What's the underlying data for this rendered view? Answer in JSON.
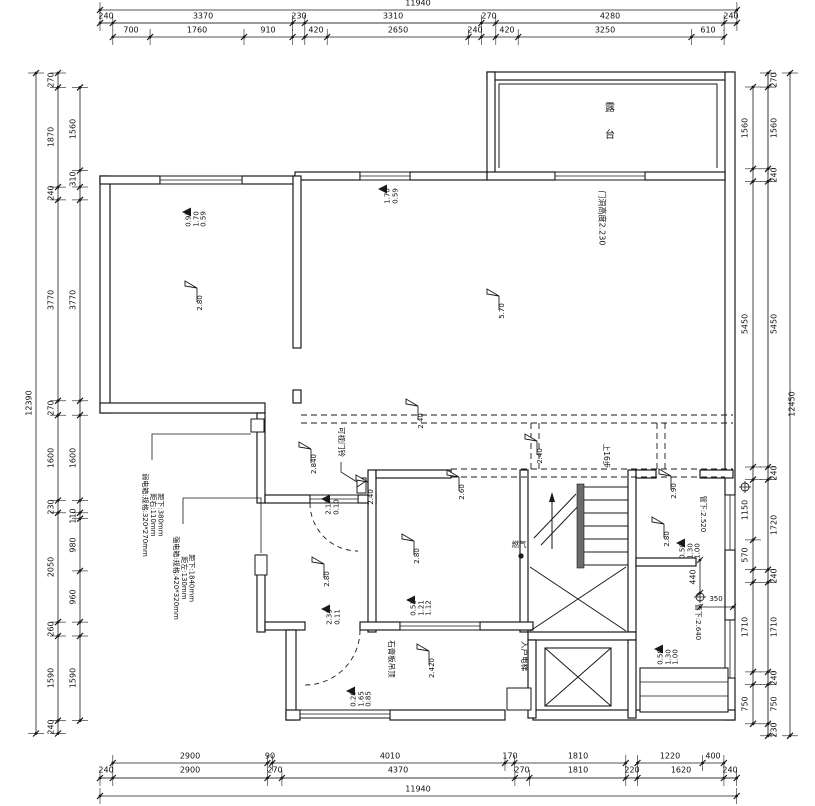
{
  "drawing": {
    "background": "#ffffff",
    "line_color": "#1a1a1a",
    "gray_line": "#9a9a9a",
    "title": "二层平面布置图"
  },
  "dimensions": {
    "top": {
      "total": "11940",
      "row1": [
        "240",
        "3370",
        "230",
        "3310",
        "270",
        "4280",
        "240"
      ],
      "row2": [
        "700",
        "1760",
        "910",
        "420",
        "2650",
        "240",
        "420",
        "3250",
        "610"
      ]
    },
    "bottom": {
      "total": "11940",
      "row1": [
        "2900",
        "90",
        "4010",
        "170",
        "1810",
        "1220",
        "400"
      ],
      "row2": [
        "240",
        "2900",
        "270",
        "4370",
        "270",
        "1810",
        "220",
        "1620",
        "240"
      ]
    },
    "left": {
      "total": "12390",
      "outer": [
        "270",
        "1870",
        "240",
        "3770",
        "270",
        "1600",
        "230",
        "2050",
        "260",
        "1590",
        "240"
      ],
      "inner": [
        "1560",
        "310",
        "3770",
        "1600",
        "110",
        "980",
        "960",
        "1590"
      ]
    },
    "right": {
      "total": "12450",
      "outer": [
        "270",
        "1560",
        "240",
        "5450",
        "240",
        "1720",
        "240",
        "1710",
        "240",
        "750",
        "230"
      ],
      "inner": [
        "1560",
        "5450",
        "1150",
        "570",
        "1710",
        "750"
      ]
    },
    "interior": {
      "w440": "440",
      "w350": "350"
    }
  },
  "rooms": {
    "terrace": "露 台"
  },
  "annotations": {
    "door_height": "门洞高度2.230",
    "doorbell": "可视门铃",
    "stairs_up": "上16步",
    "gas": "燃气",
    "elevator": "入户电梯",
    "ceiling": "石膏板吊顶",
    "pipe_upper": "管下:2.520",
    "pipe_lower": "管下:2.640",
    "weak_box": "弱电箱:规格:320*270mm\n距右:110mm\n距下:380mm",
    "strong_box": "强电箱:规格:420*320mm\n距左:130mm\n距下:1840mm"
  },
  "markers": {
    "heights": [
      "2.80",
      "5.70",
      "2.840",
      "2.40",
      "2.40",
      "2.40",
      "2.60",
      "2.80",
      "2.80",
      "2.90",
      "2.80",
      "2.420"
    ],
    "windows": [
      "0.93\n1.70\n0.59",
      "1.70\n0.59",
      "2.17\n0.10",
      "2.33\n0.11",
      "0.51\n1.21\n1.12",
      "0.20\n1.65\n0.85",
      "0.50\n1.30\n1.00",
      "0.50\n1.30\n1.00"
    ]
  },
  "labels": [
    {
      "p": "dimensions.top.total",
      "x": 418,
      "y": 4,
      "m": "h",
      "n": "dim-total-top"
    },
    {
      "p": "dimensions.top.row1.0",
      "x": 106,
      "y": 17,
      "m": "h"
    },
    {
      "p": "dimensions.top.row1.1",
      "x": 203,
      "y": 17,
      "m": "h"
    },
    {
      "p": "dimensions.top.row1.2",
      "x": 299,
      "y": 17,
      "m": "h"
    },
    {
      "p": "dimensions.top.row1.3",
      "x": 393,
      "y": 17,
      "m": "h"
    },
    {
      "p": "dimensions.top.row1.4",
      "x": 489,
      "y": 17,
      "m": "h"
    },
    {
      "p": "dimensions.top.row1.5",
      "x": 610,
      "y": 17,
      "m": "h"
    },
    {
      "p": "dimensions.top.row1.6",
      "x": 731,
      "y": 17,
      "m": "h"
    },
    {
      "p": "dimensions.top.row2.0",
      "x": 131,
      "y": 31,
      "m": "h"
    },
    {
      "p": "dimensions.top.row2.1",
      "x": 197,
      "y": 31,
      "m": "h"
    },
    {
      "p": "dimensions.top.row2.2",
      "x": 268,
      "y": 31,
      "m": "h"
    },
    {
      "p": "dimensions.top.row2.3",
      "x": 316,
      "y": 31,
      "m": "h"
    },
    {
      "p": "dimensions.top.row2.4",
      "x": 398,
      "y": 31,
      "m": "h"
    },
    {
      "p": "dimensions.top.row2.5",
      "x": 475,
      "y": 31,
      "m": "h"
    },
    {
      "p": "dimensions.top.row2.6",
      "x": 507,
      "y": 31,
      "m": "h"
    },
    {
      "p": "dimensions.top.row2.7",
      "x": 605,
      "y": 31,
      "m": "h"
    },
    {
      "p": "dimensions.top.row2.8",
      "x": 708,
      "y": 31,
      "m": "h"
    },
    {
      "p": "dimensions.bottom.row1.0",
      "x": 190,
      "y": 757,
      "m": "h"
    },
    {
      "p": "dimensions.bottom.row1.1",
      "x": 270,
      "y": 757,
      "m": "h"
    },
    {
      "p": "dimensions.bottom.row1.2",
      "x": 390,
      "y": 757,
      "m": "h"
    },
    {
      "p": "dimensions.bottom.row1.3",
      "x": 510,
      "y": 757,
      "m": "h"
    },
    {
      "p": "dimensions.bottom.row1.4",
      "x": 578,
      "y": 757,
      "m": "h"
    },
    {
      "p": "dimensions.bottom.row1.5",
      "x": 670,
      "y": 757,
      "m": "h"
    },
    {
      "p": "dimensions.bottom.row1.6",
      "x": 713,
      "y": 757,
      "m": "h"
    },
    {
      "p": "dimensions.bottom.row2.0",
      "x": 106,
      "y": 771,
      "m": "h"
    },
    {
      "p": "dimensions.bottom.row2.1",
      "x": 190,
      "y": 771,
      "m": "h"
    },
    {
      "p": "dimensions.bottom.row2.2",
      "x": 275,
      "y": 771,
      "m": "h"
    },
    {
      "p": "dimensions.bottom.row2.3",
      "x": 398,
      "y": 771,
      "m": "h"
    },
    {
      "p": "dimensions.bottom.row2.4",
      "x": 522,
      "y": 771,
      "m": "h"
    },
    {
      "p": "dimensions.bottom.row2.5",
      "x": 578,
      "y": 771,
      "m": "h"
    },
    {
      "p": "dimensions.bottom.row2.6",
      "x": 632,
      "y": 771,
      "m": "h"
    },
    {
      "p": "dimensions.bottom.row2.7",
      "x": 681,
      "y": 771,
      "m": "h"
    },
    {
      "p": "dimensions.bottom.row2.8",
      "x": 730,
      "y": 771,
      "m": "h"
    },
    {
      "p": "dimensions.bottom.total",
      "x": 418,
      "y": 790,
      "m": "h",
      "n": "dim-total-bottom"
    },
    {
      "p": "dimensions.left.total",
      "x": 30,
      "y": 403,
      "m": "v",
      "n": "dim-total-left"
    },
    {
      "p": "dimensions.left.outer.0",
      "x": 52,
      "y": 80,
      "m": "v"
    },
    {
      "p": "dimensions.left.outer.1",
      "x": 52,
      "y": 137,
      "m": "v"
    },
    {
      "p": "dimensions.left.outer.2",
      "x": 52,
      "y": 193,
      "m": "v"
    },
    {
      "p": "dimensions.left.outer.3",
      "x": 52,
      "y": 300,
      "m": "v"
    },
    {
      "p": "dimensions.left.outer.4",
      "x": 52,
      "y": 408,
      "m": "v"
    },
    {
      "p": "dimensions.left.outer.5",
      "x": 52,
      "y": 458,
      "m": "v"
    },
    {
      "p": "dimensions.left.outer.6",
      "x": 52,
      "y": 507,
      "m": "v"
    },
    {
      "p": "dimensions.left.outer.7",
      "x": 52,
      "y": 567,
      "m": "v"
    },
    {
      "p": "dimensions.left.outer.8",
      "x": 52,
      "y": 629,
      "m": "v"
    },
    {
      "p": "dimensions.left.outer.9",
      "x": 52,
      "y": 678,
      "m": "v"
    },
    {
      "p": "dimensions.left.outer.10",
      "x": 52,
      "y": 727,
      "m": "v"
    },
    {
      "p": "dimensions.left.inner.0",
      "x": 74,
      "y": 129,
      "m": "v"
    },
    {
      "p": "dimensions.left.inner.1",
      "x": 74,
      "y": 179,
      "m": "v"
    },
    {
      "p": "dimensions.left.inner.2",
      "x": 74,
      "y": 300,
      "m": "v"
    },
    {
      "p": "dimensions.left.inner.3",
      "x": 74,
      "y": 458,
      "m": "v"
    },
    {
      "p": "dimensions.left.inner.4",
      "x": 74,
      "y": 516,
      "m": "v"
    },
    {
      "p": "dimensions.left.inner.5",
      "x": 74,
      "y": 545,
      "m": "v"
    },
    {
      "p": "dimensions.left.inner.6",
      "x": 74,
      "y": 597,
      "m": "v"
    },
    {
      "p": "dimensions.left.inner.7",
      "x": 74,
      "y": 678,
      "m": "v"
    },
    {
      "p": "dimensions.right.inner.0",
      "x": 746,
      "y": 128,
      "m": "v"
    },
    {
      "p": "dimensions.right.inner.1",
      "x": 746,
      "y": 324,
      "m": "v"
    },
    {
      "p": "dimensions.right.inner.2",
      "x": 746,
      "y": 510,
      "m": "v"
    },
    {
      "p": "dimensions.right.inner.3",
      "x": 746,
      "y": 555,
      "m": "v"
    },
    {
      "p": "dimensions.right.inner.4",
      "x": 746,
      "y": 627,
      "m": "v"
    },
    {
      "p": "dimensions.right.inner.5",
      "x": 746,
      "y": 704,
      "m": "v"
    },
    {
      "p": "dimensions.right.outer.0",
      "x": 775,
      "y": 80,
      "m": "v"
    },
    {
      "p": "dimensions.right.outer.1",
      "x": 775,
      "y": 128,
      "m": "v"
    },
    {
      "p": "dimensions.right.outer.2",
      "x": 775,
      "y": 175,
      "m": "v"
    },
    {
      "p": "dimensions.right.outer.3",
      "x": 775,
      "y": 324,
      "m": "v"
    },
    {
      "p": "dimensions.right.outer.4",
      "x": 775,
      "y": 473,
      "m": "v"
    },
    {
      "p": "dimensions.right.outer.5",
      "x": 775,
      "y": 525,
      "m": "v"
    },
    {
      "p": "dimensions.right.outer.6",
      "x": 775,
      "y": 576,
      "m": "v"
    },
    {
      "p": "dimensions.right.outer.7",
      "x": 775,
      "y": 627,
      "m": "v"
    },
    {
      "p": "dimensions.right.outer.8",
      "x": 775,
      "y": 678,
      "m": "v"
    },
    {
      "p": "dimensions.right.outer.9",
      "x": 775,
      "y": 704,
      "m": "v"
    },
    {
      "p": "dimensions.right.outer.10",
      "x": 775,
      "y": 730,
      "m": "v"
    },
    {
      "p": "dimensions.right.total",
      "x": 793,
      "y": 404,
      "m": "v",
      "n": "dim-total-right"
    },
    {
      "p": "dimensions.interior.w440",
      "x": 694,
      "y": 577,
      "m": "v"
    },
    {
      "p": "dimensions.interior.w350",
      "x": 716,
      "y": 600,
      "m": "h",
      "s": 7
    },
    {
      "p": "markers.windows.0",
      "x": 197,
      "y": 219,
      "m": "v",
      "s": 7,
      "n": "window-marker"
    },
    {
      "p": "markers.windows.1",
      "x": 392,
      "y": 196,
      "m": "v",
      "s": 7,
      "n": "window-marker"
    },
    {
      "p": "markers.windows.2",
      "x": 333,
      "y": 507,
      "m": "v",
      "s": 7,
      "n": "window-marker"
    },
    {
      "p": "markers.windows.3",
      "x": 334,
      "y": 617,
      "m": "v",
      "s": 7,
      "n": "window-marker"
    },
    {
      "p": "markers.windows.4",
      "x": 422,
      "y": 608,
      "m": "v",
      "s": 7,
      "n": "window-marker"
    },
    {
      "p": "markers.windows.5",
      "x": 362,
      "y": 699,
      "m": "v",
      "s": 7,
      "n": "window-marker"
    },
    {
      "p": "markers.windows.6",
      "x": 691,
      "y": 551,
      "m": "v",
      "s": 7,
      "n": "window-marker"
    },
    {
      "p": "markers.windows.7",
      "x": 669,
      "y": 657,
      "m": "v",
      "s": 7,
      "n": "window-marker"
    },
    {
      "p": "markers.heights.0",
      "x": 201,
      "y": 303,
      "m": "v",
      "s": 7,
      "n": "height-marker"
    },
    {
      "p": "markers.heights.1",
      "x": 503,
      "y": 311,
      "m": "v",
      "s": 7,
      "n": "height-marker"
    },
    {
      "p": "markers.heights.2",
      "x": 315,
      "y": 464,
      "m": "v",
      "s": 7,
      "n": "height-marker"
    },
    {
      "p": "markers.heights.3",
      "x": 422,
      "y": 421,
      "m": "v",
      "s": 7,
      "n": "height-marker"
    },
    {
      "p": "markers.heights.4",
      "x": 541,
      "y": 456,
      "m": "v",
      "s": 7,
      "n": "height-marker"
    },
    {
      "p": "markers.heights.5",
      "x": 372,
      "y": 497,
      "m": "v",
      "s": 7,
      "n": "height-marker"
    },
    {
      "p": "markers.heights.6",
      "x": 463,
      "y": 492,
      "m": "v",
      "s": 7,
      "n": "height-marker"
    },
    {
      "p": "markers.heights.7",
      "x": 418,
      "y": 556,
      "m": "v",
      "s": 7,
      "n": "height-marker"
    },
    {
      "p": "markers.heights.8",
      "x": 328,
      "y": 579,
      "m": "v",
      "s": 7,
      "n": "height-marker"
    },
    {
      "p": "markers.heights.9",
      "x": 675,
      "y": 491,
      "m": "v",
      "s": 7,
      "n": "height-marker"
    },
    {
      "p": "markers.heights.10",
      "x": 668,
      "y": 539,
      "m": "v",
      "s": 7,
      "n": "height-marker"
    },
    {
      "p": "markers.heights.11",
      "x": 433,
      "y": 668,
      "m": "v",
      "s": 7,
      "n": "height-marker"
    },
    {
      "p": "rooms.terrace",
      "x": 608,
      "y": 122,
      "m": "up",
      "s": 10,
      "n": "room-label-terrace"
    },
    {
      "p": "annotations.door_height",
      "x": 601,
      "y": 218,
      "m": "sd",
      "s": 8,
      "n": "door-height-note"
    },
    {
      "p": "annotations.doorbell",
      "x": 341,
      "y": 442,
      "m": "sd",
      "s": 7.5,
      "n": "doorbell-note"
    },
    {
      "p": "annotations.stairs_up",
      "x": 606,
      "y": 456,
      "m": "sd",
      "s": 7.5,
      "n": "stairs-up-note"
    },
    {
      "p": "annotations.gas",
      "x": 519,
      "y": 545,
      "m": "h",
      "s": 7.5,
      "n": "gas-note"
    },
    {
      "p": "annotations.elevator",
      "x": 524,
      "y": 656,
      "m": "sd",
      "s": 7.5,
      "n": "elevator-label"
    },
    {
      "p": "annotations.ceiling",
      "x": 391,
      "y": 659,
      "m": "sd",
      "s": 7.5,
      "n": "ceiling-note"
    },
    {
      "p": "annotations.pipe_upper",
      "x": 702,
      "y": 514,
      "m": "sd",
      "s": 7,
      "n": "pipe-note"
    },
    {
      "p": "annotations.pipe_lower",
      "x": 697,
      "y": 622,
      "m": "sd",
      "s": 7,
      "n": "pipe-note"
    },
    {
      "p": "annotations.weak_box",
      "x": 152,
      "y": 515,
      "m": "sd",
      "s": 7,
      "n": "weak-current-box-note"
    },
    {
      "p": "annotations.strong_box",
      "x": 183,
      "y": 578,
      "m": "sd",
      "s": 7,
      "n": "strong-current-box-note"
    }
  ]
}
